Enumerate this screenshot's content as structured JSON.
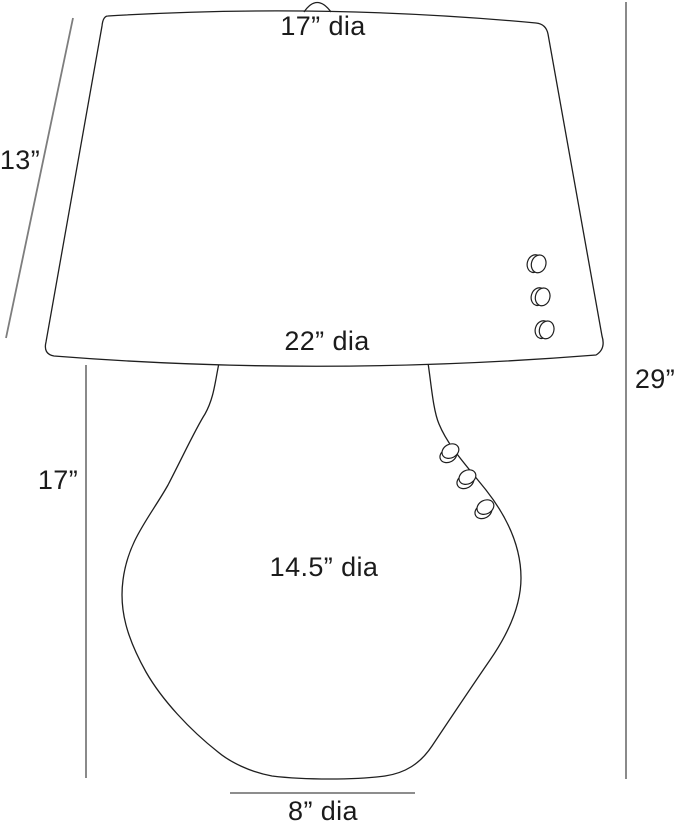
{
  "colors": {
    "background": "#ffffff",
    "outline": "#1f1f1f",
    "dimension_line": "#7d7d7d",
    "label_text": "#1b1b1b"
  },
  "labels": {
    "shade_top_diameter": "17” dia",
    "shade_slant_height": "13”",
    "shade_bottom_diameter": "22” dia",
    "overall_height": "29”",
    "body_height": "17”",
    "body_diameter": "14.5” dia",
    "base_diameter": "8” dia"
  }
}
